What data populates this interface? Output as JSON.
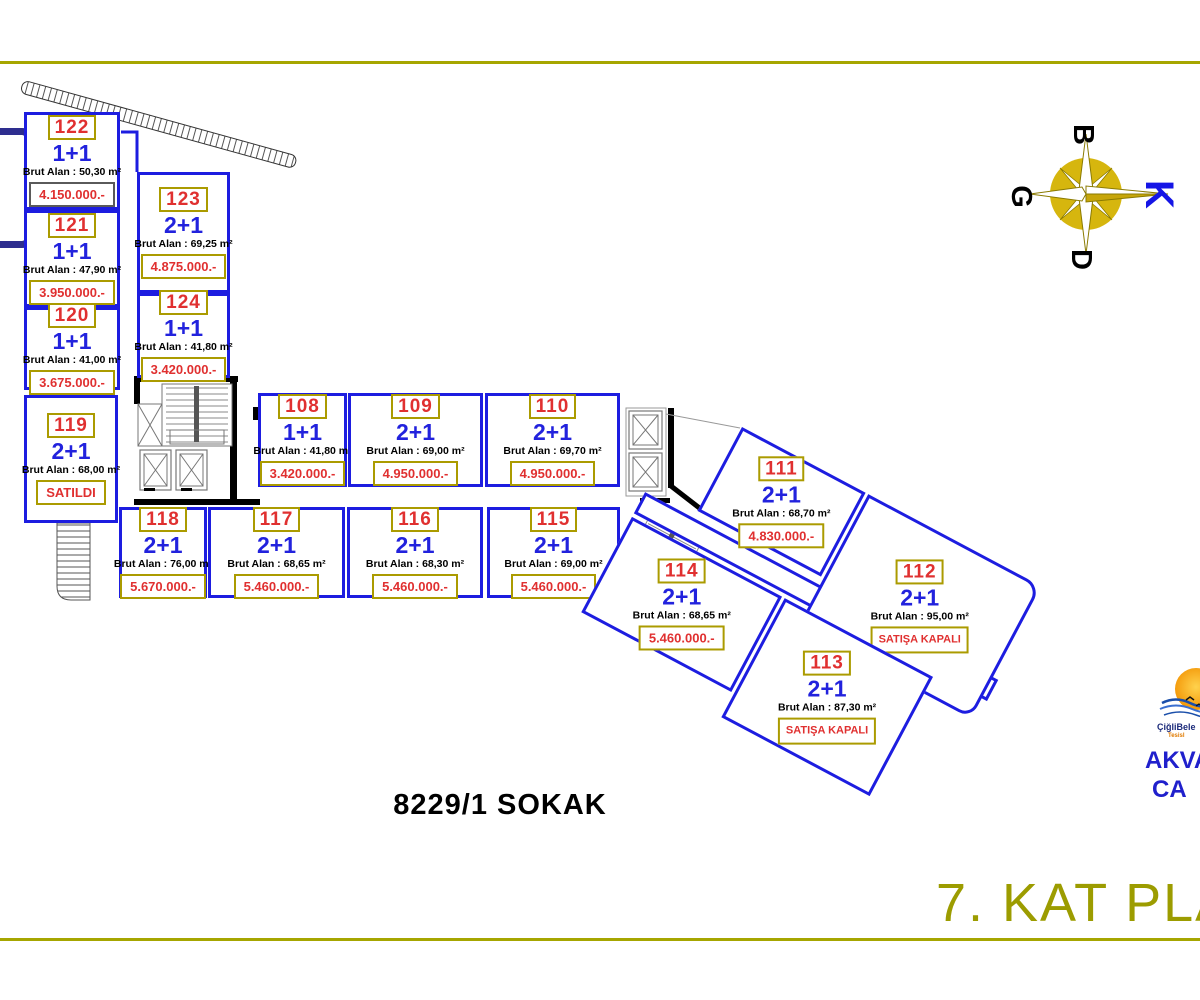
{
  "title": {
    "floor_plan": "7. KAT PLA"
  },
  "street": {
    "label": "8229/1 SOKAK"
  },
  "compass": {
    "top": "B",
    "left": "G",
    "bottom": "D",
    "right": "K"
  },
  "logo": {
    "org": "ÇiğliBele",
    "sub": "Tesisl",
    "line1": "AKVAR",
    "line2": "CA"
  },
  "labels": {
    "area_prefix": "Brut Alan :"
  },
  "colors": {
    "unit_border_blue": "#1d1de0",
    "type_blue": "#2222dd",
    "number_red": "#e03030",
    "box_border_olive": "#ab9b00",
    "rule_olive": "#a6a600",
    "title_olive": "#9c9c00",
    "compass_gold": "#d6b60e",
    "compass_north_blue": "#1515e6",
    "brand_blue": "#2020cc"
  },
  "units": [
    {
      "number": "122",
      "type": "1+1",
      "area": "50,30 m²",
      "price_or_status": "4.150.000.-"
    },
    {
      "number": "121",
      "type": "1+1",
      "area": "47,90 m²",
      "price_or_status": "3.950.000.-"
    },
    {
      "number": "120",
      "type": "1+1",
      "area": "41,00 m²",
      "price_or_status": "3.675.000.-"
    },
    {
      "number": "119",
      "type": "2+1",
      "area": "68,00 m²",
      "price_or_status": "SATILDI"
    },
    {
      "number": "123",
      "type": "2+1",
      "area": "69,25 m²",
      "price_or_status": "4.875.000.-"
    },
    {
      "number": "124",
      "type": "1+1",
      "area": "41,80 m²",
      "price_or_status": "3.420.000.-"
    },
    {
      "number": "108",
      "type": "1+1",
      "area": "41,80 m²",
      "price_or_status": "3.420.000.-"
    },
    {
      "number": "109",
      "type": "2+1",
      "area": "69,00 m²",
      "price_or_status": "4.950.000.-"
    },
    {
      "number": "110",
      "type": "2+1",
      "area": "69,70 m²",
      "price_or_status": "4.950.000.-"
    },
    {
      "number": "118",
      "type": "2+1",
      "area": "76,00 m²",
      "price_or_status": "5.670.000.-"
    },
    {
      "number": "117",
      "type": "2+1",
      "area": "68,65 m²",
      "price_or_status": "5.460.000.-"
    },
    {
      "number": "116",
      "type": "2+1",
      "area": "68,30 m²",
      "price_or_status": "5.460.000.-"
    },
    {
      "number": "115",
      "type": "2+1",
      "area": "69,00 m²",
      "price_or_status": "5.460.000.-"
    },
    {
      "number": "111",
      "type": "2+1",
      "area": "68,70 m²",
      "price_or_status": "4.830.000.-"
    },
    {
      "number": "112",
      "type": "2+1",
      "area": "95,00 m²",
      "price_or_status": "SATIŞA KAPALI"
    },
    {
      "number": "113",
      "type": "2+1",
      "area": "87,30 m²",
      "price_or_status": "SATIŞA KAPALI"
    },
    {
      "number": "114",
      "type": "2+1",
      "area": "68,65 m²",
      "price_or_status": "5.460.000.-"
    }
  ]
}
